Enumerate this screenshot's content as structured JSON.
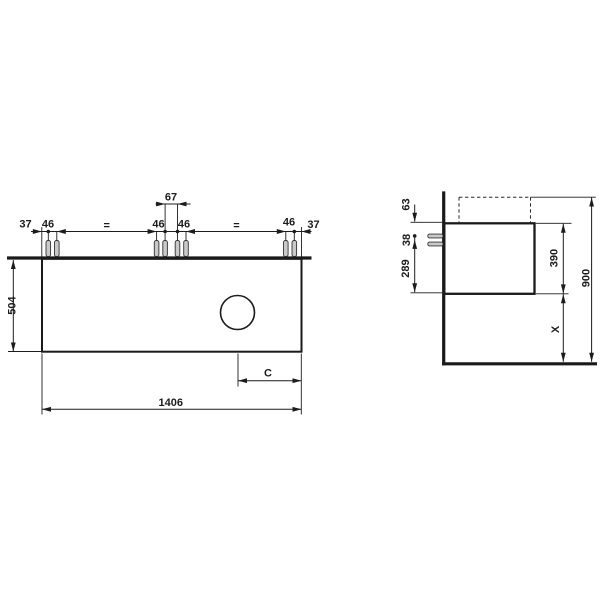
{
  "drawing_type": "technical-dimension-drawing",
  "front_view": {
    "top_dims": {
      "left_37": "37",
      "left_46": "46",
      "left_eq": "=",
      "inner_left_46": "46",
      "center_67": "67",
      "inner_right_46": "46",
      "right_eq": "=",
      "right_46": "46",
      "right_37": "37"
    },
    "height_504": "504",
    "width_1406": "1406",
    "drain_offset_c": "C"
  },
  "side_view": {
    "top_63": "63",
    "screw_gap_38": "38",
    "screw_to_bottom_289": "289",
    "body_height_390": "390",
    "floor_clearance_x": "X",
    "total_height_900": "900"
  },
  "colors": {
    "background": "#ffffff",
    "line": "#1c1c1c",
    "thick_line": "#1a1a1a",
    "pin_fill": "#c9c9c9"
  }
}
